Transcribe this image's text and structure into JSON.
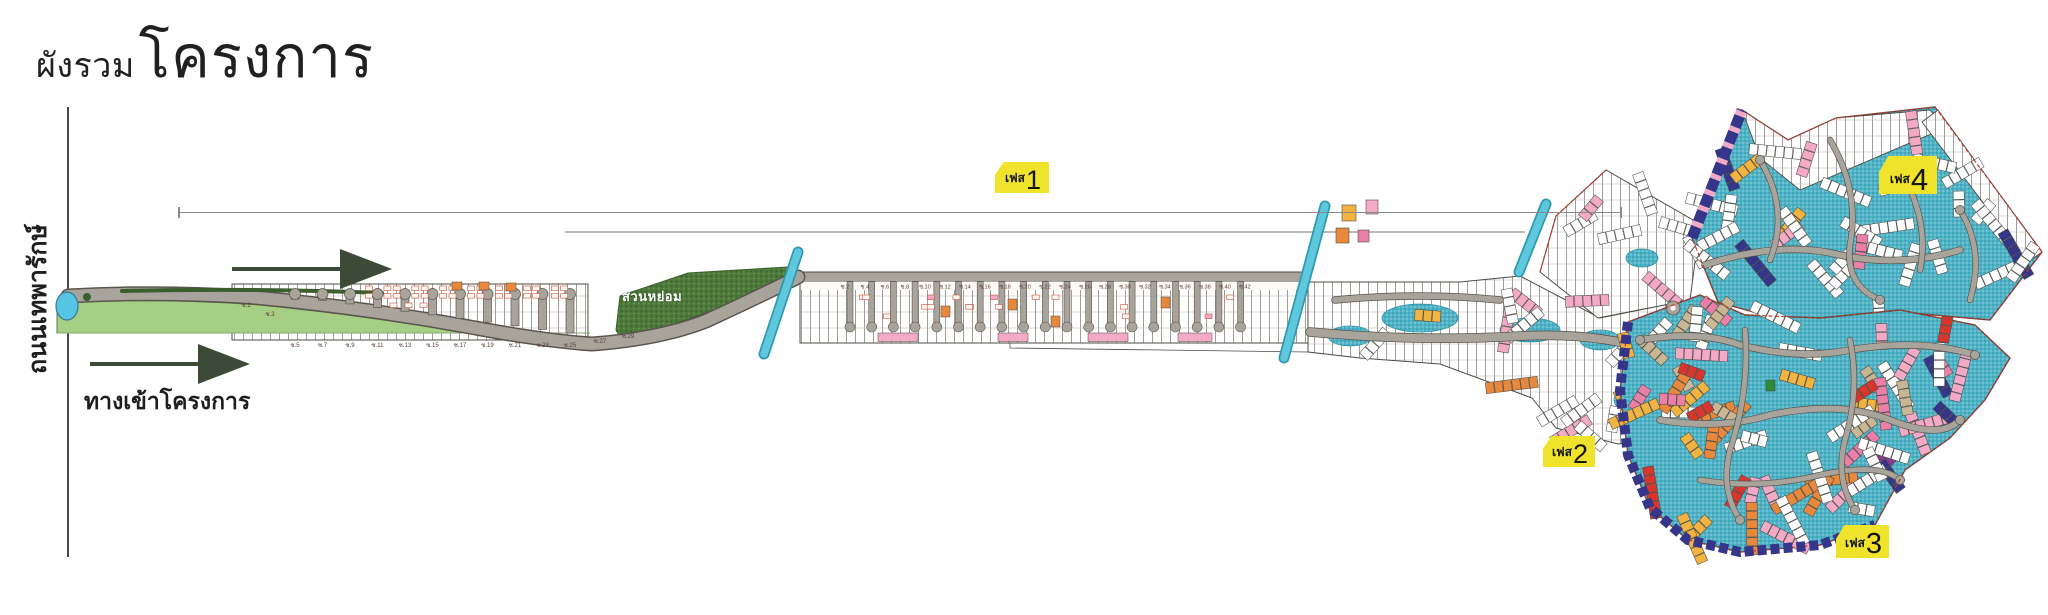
{
  "title": {
    "small": "ผังรวม",
    "large": "โครงการ"
  },
  "labels": {
    "road": "ถนนเทพารักษ์",
    "entrance": "ทางเข้าโครงการ",
    "garden": "สวนหย่อม"
  },
  "phases": [
    {
      "prefix": "เฟส",
      "number": "1"
    },
    {
      "prefix": "เฟส",
      "number": "2"
    },
    {
      "prefix": "เฟส",
      "number": "3"
    },
    {
      "prefix": "เฟส",
      "number": "4"
    }
  ],
  "streets": {
    "bottom": [
      "ซ.1",
      "ซ.3",
      "ซ.5",
      "ซ.7",
      "ซ.9",
      "ซ.11",
      "ซ.13",
      "ซ.15",
      "ซ.17",
      "ซ.19",
      "ซ.21",
      "ซ.23",
      "ซ.25",
      "ซ.27",
      "ซ.29"
    ],
    "top": [
      "ซ.2",
      "ซ.4",
      "ซ.6",
      "ซ.8",
      "ซ.10",
      "ซ.12",
      "ซ.14",
      "ซ.16",
      "ซ.18",
      "ซ.20",
      "ซ.22",
      "ซ.24",
      "ซ.26",
      "ซ.28",
      "ซ.30",
      "ซ.32",
      "ซ.34",
      "ซ.36",
      "ซ.38",
      "ซ.40",
      "ซ.42"
    ]
  },
  "colors": {
    "cyan": "#4fb3c6",
    "cyan_dark": "#2e93a8",
    "canal": "#5fc8dc",
    "canal_dark": "#2f99b2",
    "navy": "#35358a",
    "orange": "#e8883c",
    "amber": "#f2b340",
    "pink": "#f4aac6",
    "rose": "#ec7fa8",
    "red": "#d8362c",
    "tan": "#c8b694",
    "green": "#2e8b3a",
    "purple": "#8a3c8a",
    "lawn": "#a6ce85",
    "garden": "#4e7a3c",
    "garden_dark": "#3a5e2c",
    "road": "#a8a49c",
    "road_edge": "#5a564e",
    "outline": "#4b4b46",
    "phase_yellow": "#efe32b",
    "pond": "#56c4e4",
    "arrow": "#3d4a38",
    "house_mark": "#c4543c",
    "dim_line": "#8a8a8a",
    "soi_text": "#5a3a30",
    "boundary_dash": "#c0392b",
    "white_plot": "#ffffff"
  }
}
